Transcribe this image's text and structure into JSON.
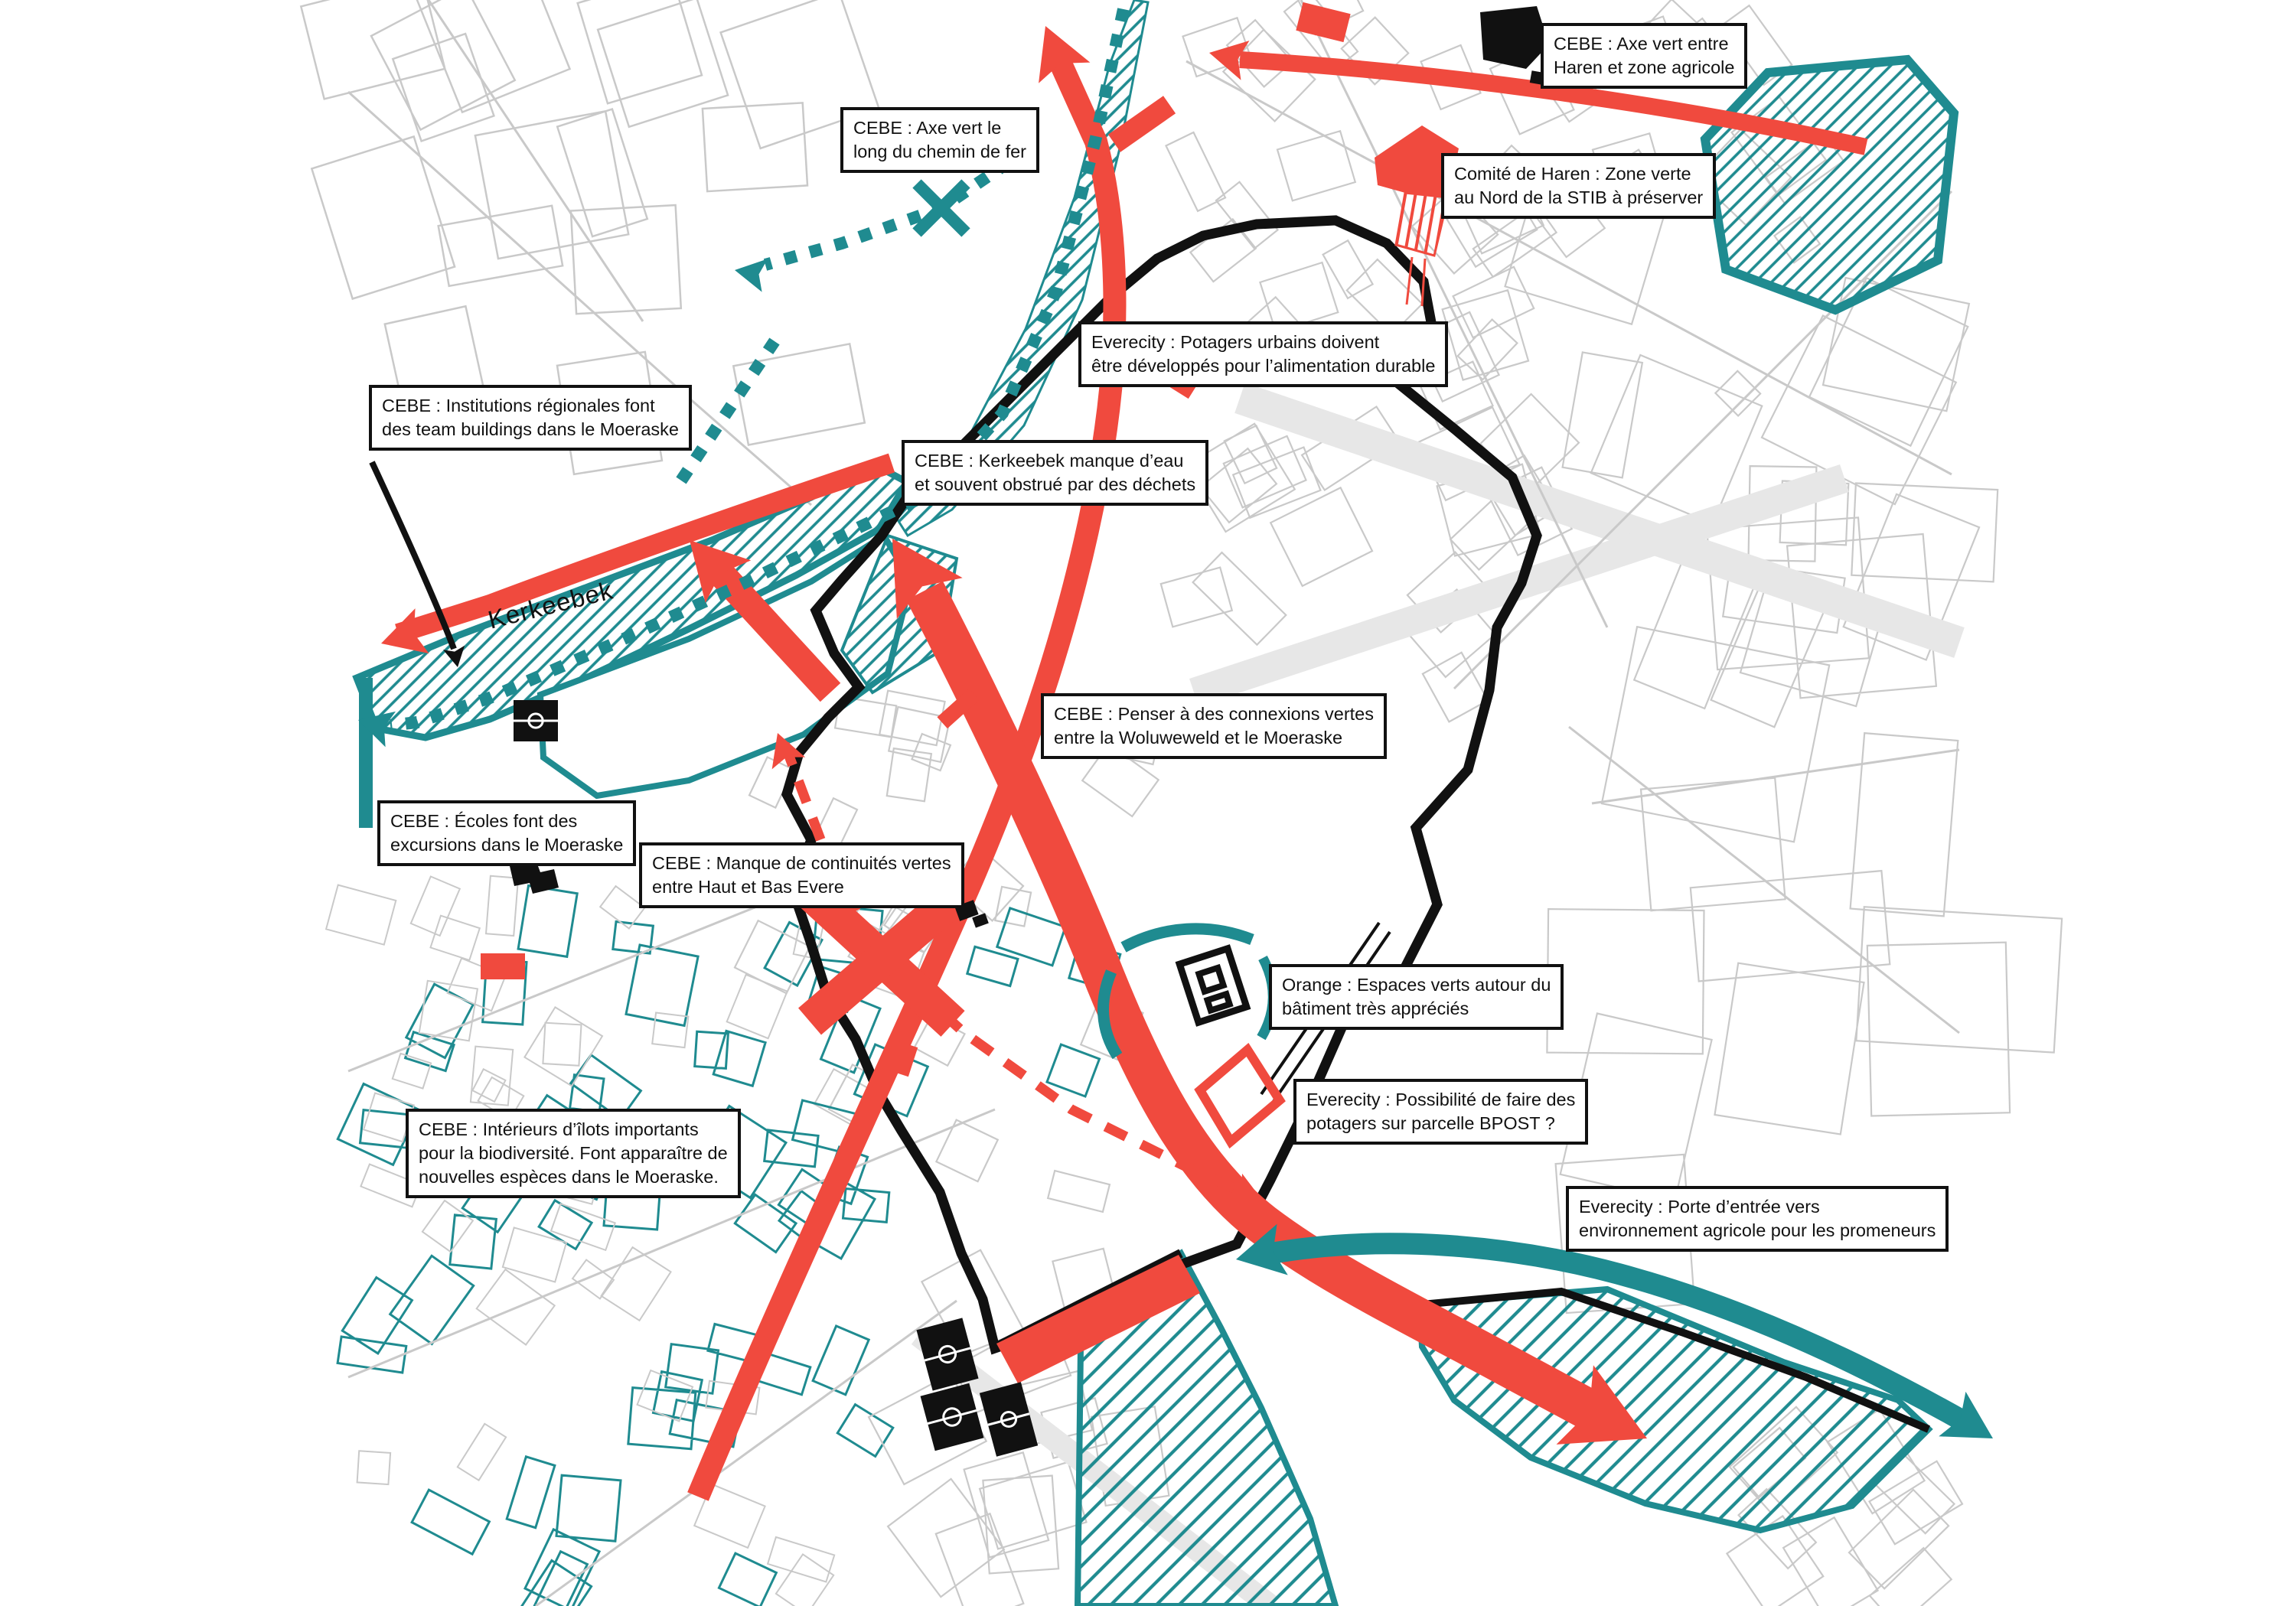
{
  "colors": {
    "red": "#f04a3e",
    "teal": "#1f8b90",
    "ink": "#111111",
    "street": "#c9c9c9",
    "street2": "#e7e7e7"
  },
  "map_label": {
    "stream": "Kerkeebek"
  },
  "annotations": [
    {
      "line1": "CEBE : Axe vert entre",
      "line2": "Haren et zone agricole"
    },
    {
      "line1": "CEBE : Axe vert le",
      "line2": "long du chemin de fer"
    },
    {
      "line1": "Comité de Haren : Zone verte",
      "line2": "au Nord de la STIB à préserver"
    },
    {
      "line1": "Everecity : Potagers urbains doivent",
      "line2": "être développés pour l’alimentation durable"
    },
    {
      "line1": "CEBE :  Institutions régionales font",
      "line2": "des team buildings dans le Moeraske"
    },
    {
      "line1": "CEBE :  Kerkeebek manque d’eau",
      "line2": "et souvent obstrué par des déchets"
    },
    {
      "line1": "CEBE :  Penser à des connexions vertes",
      "line2": "entre la Woluweweld et le Moeraske"
    },
    {
      "line1": "CEBE :  Écoles font des",
      "line2": "excursions dans le Moeraske"
    },
    {
      "line1": "CEBE : Manque de continuités vertes",
      "line2": "entre Haut et Bas Evere"
    },
    {
      "line1": "Orange :  Espaces verts autour du",
      "line2": "bâtiment très appréciés"
    },
    {
      "line1": "Everecity : Possibilité de faire des",
      "line2": "potagers sur parcelle BPOST ?"
    },
    {
      "line1": "CEBE : Intérieurs d’îlots importants",
      "line2": "pour la biodiversité. Font apparaître de",
      "line3": "nouvelles espèces dans le Moeraske."
    },
    {
      "line1": "Everecity : Porte d’entrée vers",
      "line2": "environnement agricole pour les promeneurs"
    }
  ]
}
